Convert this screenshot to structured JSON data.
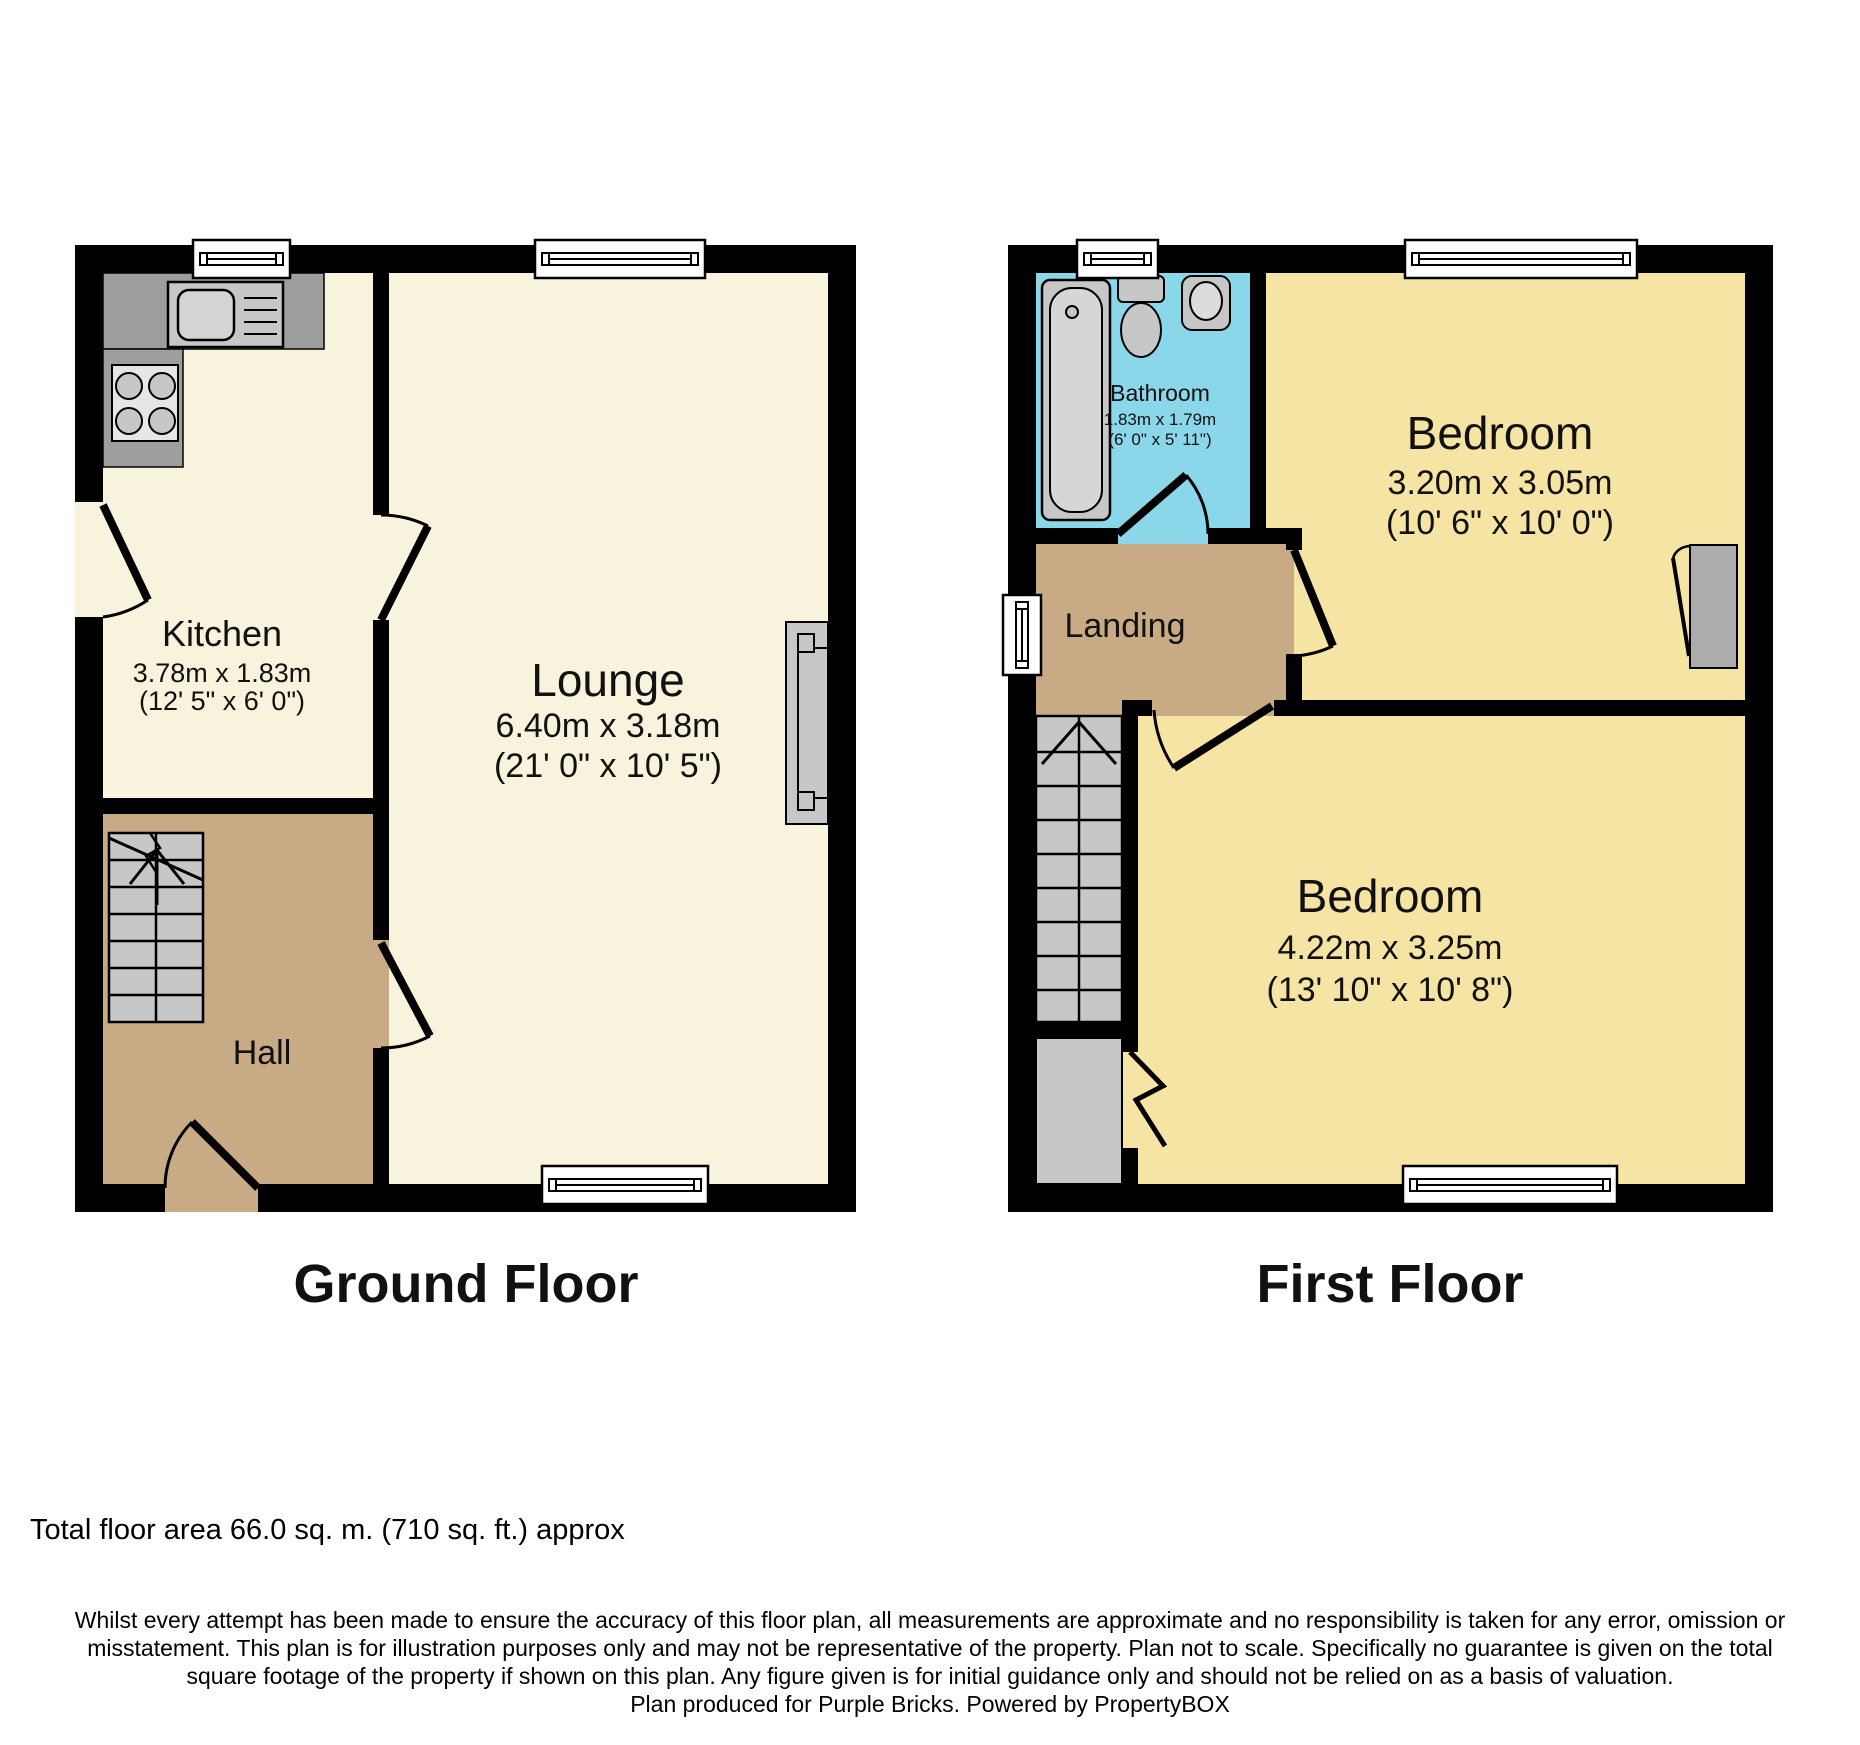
{
  "ground_floor": {
    "title": "Ground Floor",
    "kitchen_name": "Kitchen",
    "kitchen_dims_m": "3.78m x 1.83m",
    "kitchen_dims_ft": "(12' 5\" x 6' 0\")",
    "lounge_name": "Lounge",
    "lounge_dims_m": "6.40m x 3.18m",
    "lounge_dims_ft": "(21' 0\" x 10' 5\")",
    "hall_name": "Hall"
  },
  "first_floor": {
    "title": "First Floor",
    "bathroom_name": "Bathroom",
    "bathroom_dims_m": "1.83m x 1.79m",
    "bathroom_dims_ft": "(6' 0\" x 5' 11\")",
    "bedroom_front_name": "Bedroom",
    "bedroom_front_dims_m": "3.20m x 3.05m",
    "bedroom_front_dims_ft": "(10' 6\" x 10' 0\")",
    "bedroom_back_name": "Bedroom",
    "bedroom_back_dims_m": "4.22m x 3.25m",
    "bedroom_back_dims_ft": "(13' 10\" x 10' 8\")",
    "landing_name": "Landing"
  },
  "footer": {
    "total_area": "Total floor area 66.0 sq. m. (710 sq. ft.) approx",
    "disclaimer_lines": [
      "Whilst every attempt has been made to ensure the accuracy of this floor plan, all measurements are approximate and no responsibility is taken for any error, omission or",
      "misstatement. This plan is for illustration purposes only and may not be representative of the property. Plan not to scale. Specifically no guarantee is given on the total",
      "square footage of the property if shown on this plan. Any figure given is for initial guidance only and should not be relied on as a basis of valuation.",
      "Plan produced for Purple Bricks. Powered by PropertyBOX"
    ]
  },
  "colors": {
    "room_cream": "#F8F3DC",
    "room_yellow": "#F6E4A4",
    "hall_tan": "#C8AB85",
    "bathroom_cyan": "#8BD7EA",
    "fixture_gray": "#C7C7C7",
    "counter_gray": "#9E9E9E",
    "wall_black": "#000000"
  }
}
